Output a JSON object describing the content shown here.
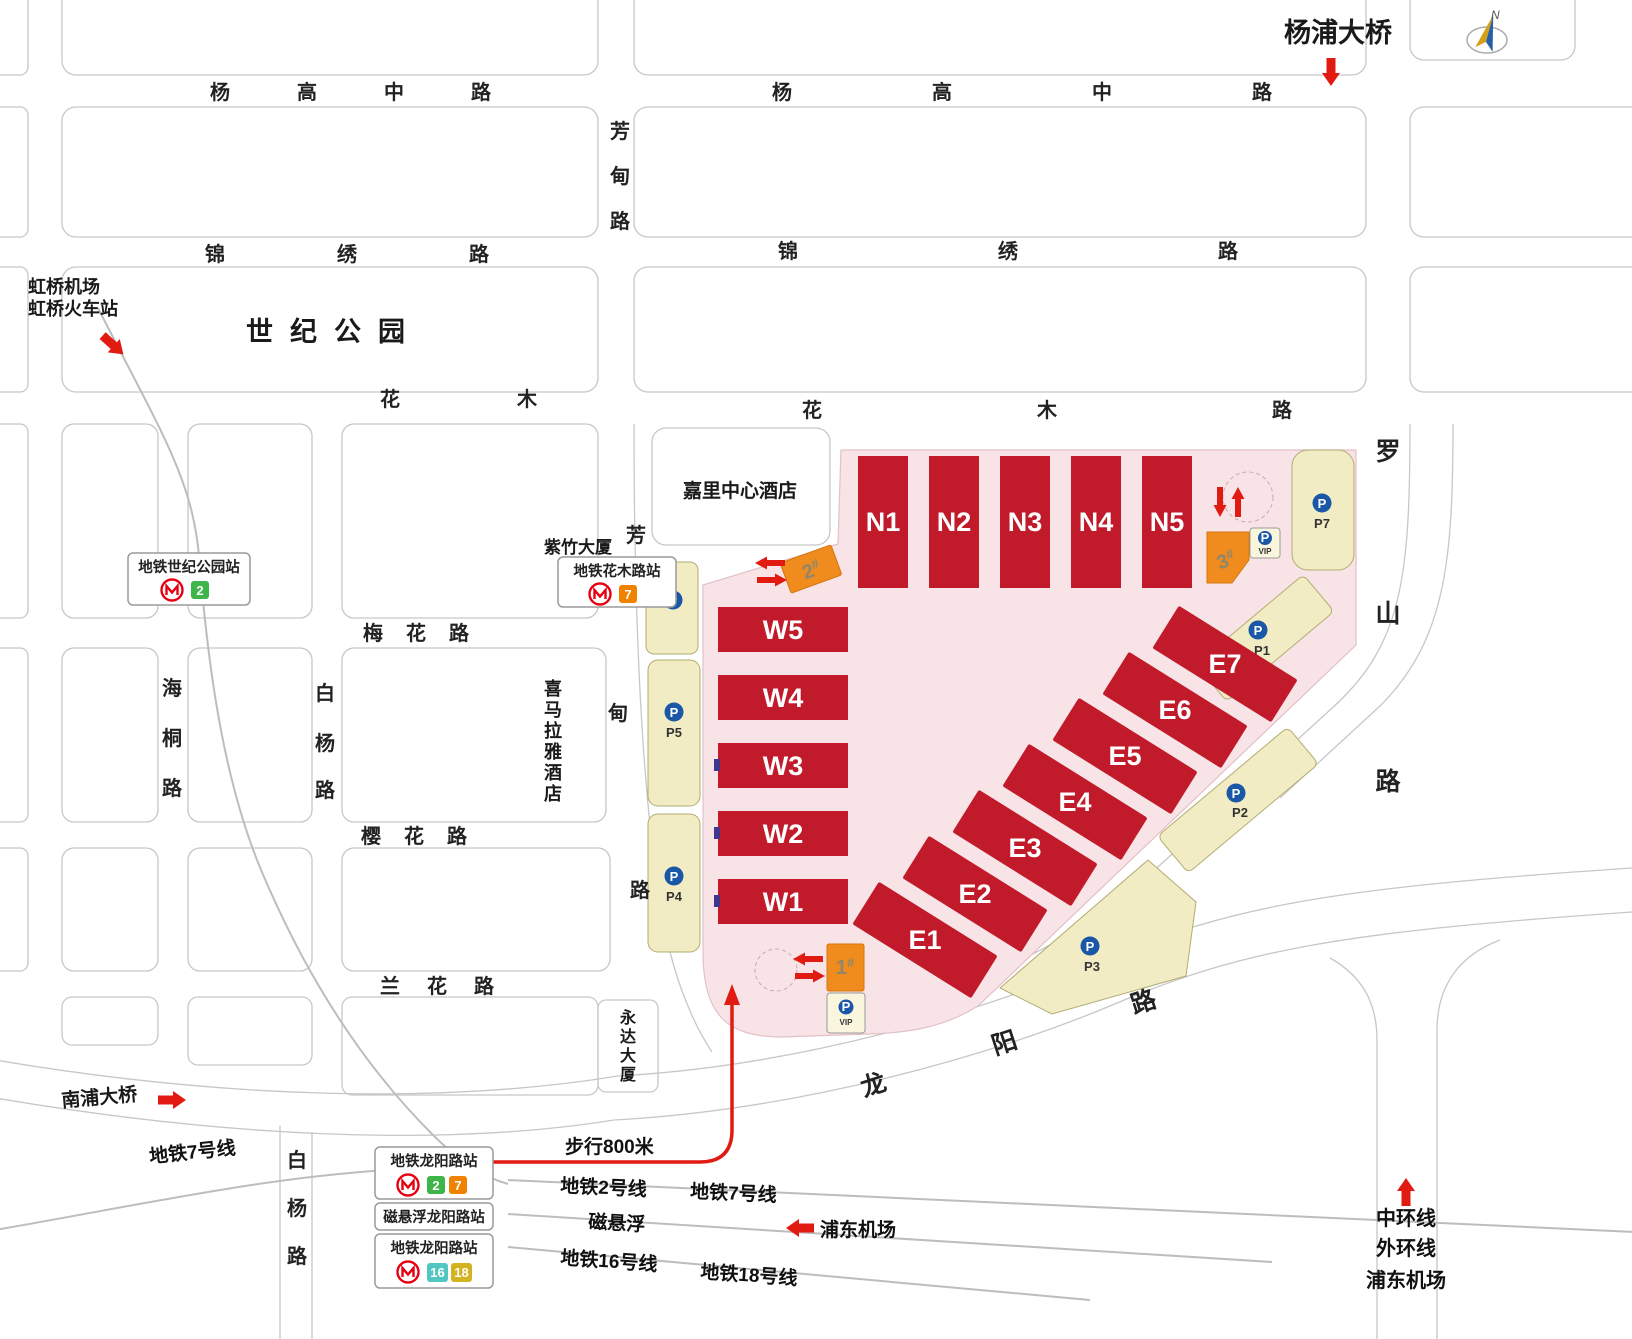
{
  "landmarks": {
    "hongqiao": [
      "虹桥机场",
      "虹桥火车站"
    ],
    "century_park": "世纪公园",
    "yangpu_bridge": "杨浦大桥",
    "nanpu_bridge": "南浦大桥",
    "kerry_hotel": "嘉里中心酒店",
    "zizhu_tower": "紫竹大厦",
    "himalaya_hotel": [
      "喜",
      "马",
      "拉",
      "雅",
      "酒",
      "店"
    ],
    "yongda_tower": [
      "永",
      "达",
      "大",
      "厦"
    ],
    "compass": "N"
  },
  "roads": {
    "yanggaozhong_w": "杨高中路",
    "yanggaozhong_e": "杨高中路",
    "jinxiu_w": "锦绣路",
    "jinxiu_e": "锦绣路",
    "huamu_w": "花木",
    "huamu_e": "花木路",
    "meihua": "梅花路",
    "yinghua": "樱花路",
    "lanhua": "兰花路",
    "fangdian_n": [
      "芳",
      "甸",
      "路"
    ],
    "fangdian_s": [
      "芳",
      "甸",
      "路"
    ],
    "haitong": [
      "海",
      "桐",
      "路"
    ],
    "baiyang_n": [
      "白",
      "杨",
      "路"
    ],
    "baiyang_s": [
      "白",
      "杨",
      "路"
    ],
    "luoshan": [
      "罗",
      "山",
      "路"
    ],
    "longyang": [
      "龙",
      "阳",
      "路"
    ]
  },
  "halls": {
    "north": [
      "N1",
      "N2",
      "N3",
      "N4",
      "N5"
    ],
    "west": [
      "W5",
      "W4",
      "W3",
      "W2",
      "W1"
    ],
    "east": [
      "E1",
      "E2",
      "E3",
      "E4",
      "E5",
      "E6",
      "E7"
    ]
  },
  "gates": [
    {
      "num": "2",
      "suffix": "#"
    },
    {
      "num": "3",
      "suffix": "#"
    },
    {
      "num": "1",
      "suffix": "#"
    }
  ],
  "parking": {
    "p": "P",
    "vip": "VIP",
    "lots": [
      "P7",
      "P1",
      "P2",
      "P3",
      "P4",
      "P5"
    ]
  },
  "stations": [
    {
      "name": "地铁世纪公园站",
      "lines": [
        {
          "n": "2",
          "color": "#3eb44a"
        }
      ]
    },
    {
      "name": "地铁花木路站",
      "lines": [
        {
          "n": "7",
          "color": "#f08200"
        }
      ]
    },
    {
      "name": "地铁龙阳路站",
      "lines": [
        {
          "n": "2",
          "color": "#3eb44a"
        },
        {
          "n": "7",
          "color": "#f08200"
        }
      ]
    },
    {
      "name": "磁悬浮龙阳路站",
      "lines": []
    },
    {
      "name": "地铁龙阳路站",
      "lines": [
        {
          "n": "16",
          "color": "#52c7c2"
        },
        {
          "n": "18",
          "color": "#d3b420"
        }
      ]
    }
  ],
  "transit": {
    "line7_w": "地铁7号线",
    "walk": "步行800米",
    "line2": "地铁2号线",
    "line7": "地铁7号线",
    "maglev": "磁悬浮",
    "pudong_airport": "浦东机场",
    "line16": "地铁16号线",
    "line18": "地铁18号线",
    "mid_ring": "中环线",
    "outer_ring": "外环线",
    "pudong_airport2": "浦东机场"
  },
  "colors": {
    "hall_red": "#c11a2b",
    "expo_pink": "#f8e4e6",
    "parking_yellow": "#f1ecc3",
    "gate_orange": "#ef8c1d",
    "metro_logo_red": "#e60012",
    "arrow_red": "#e11b12"
  }
}
